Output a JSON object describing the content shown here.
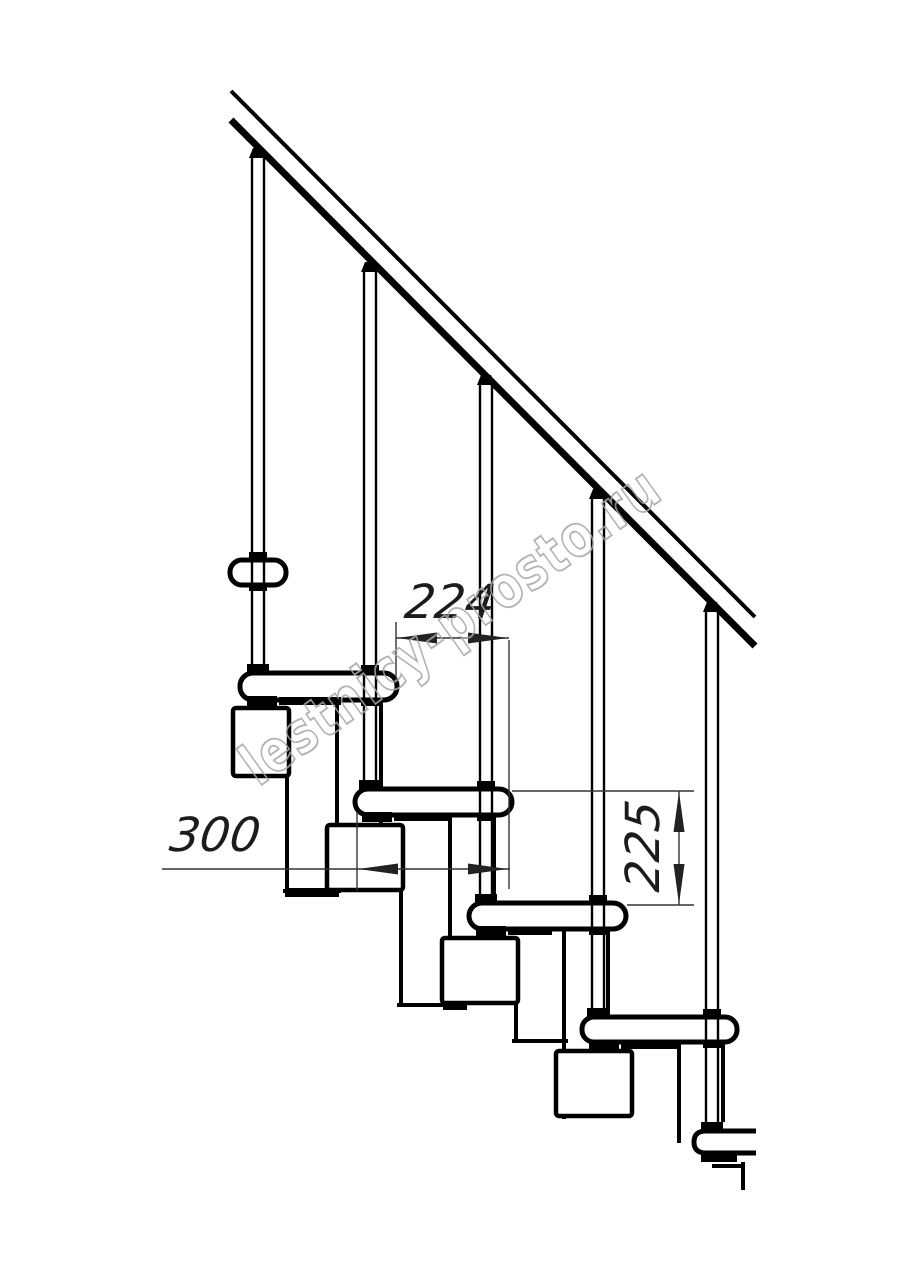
{
  "figure": {
    "title": "modular-staircase-side-elevation",
    "background_color": "#ffffff",
    "line_color": "#000000",
    "dimension_line_color": "#333333",
    "balusters_count": 5,
    "treads_count": 5
  },
  "dimensions": {
    "d224": {
      "label": "224",
      "orientation": "horizontal"
    },
    "d300": {
      "label": "300",
      "orientation": "horizontal"
    },
    "d225": {
      "label": "225",
      "orientation": "vertical"
    }
  },
  "watermark": {
    "text": "lestnicy-prosto.ru",
    "color": "#a6a6a6"
  }
}
